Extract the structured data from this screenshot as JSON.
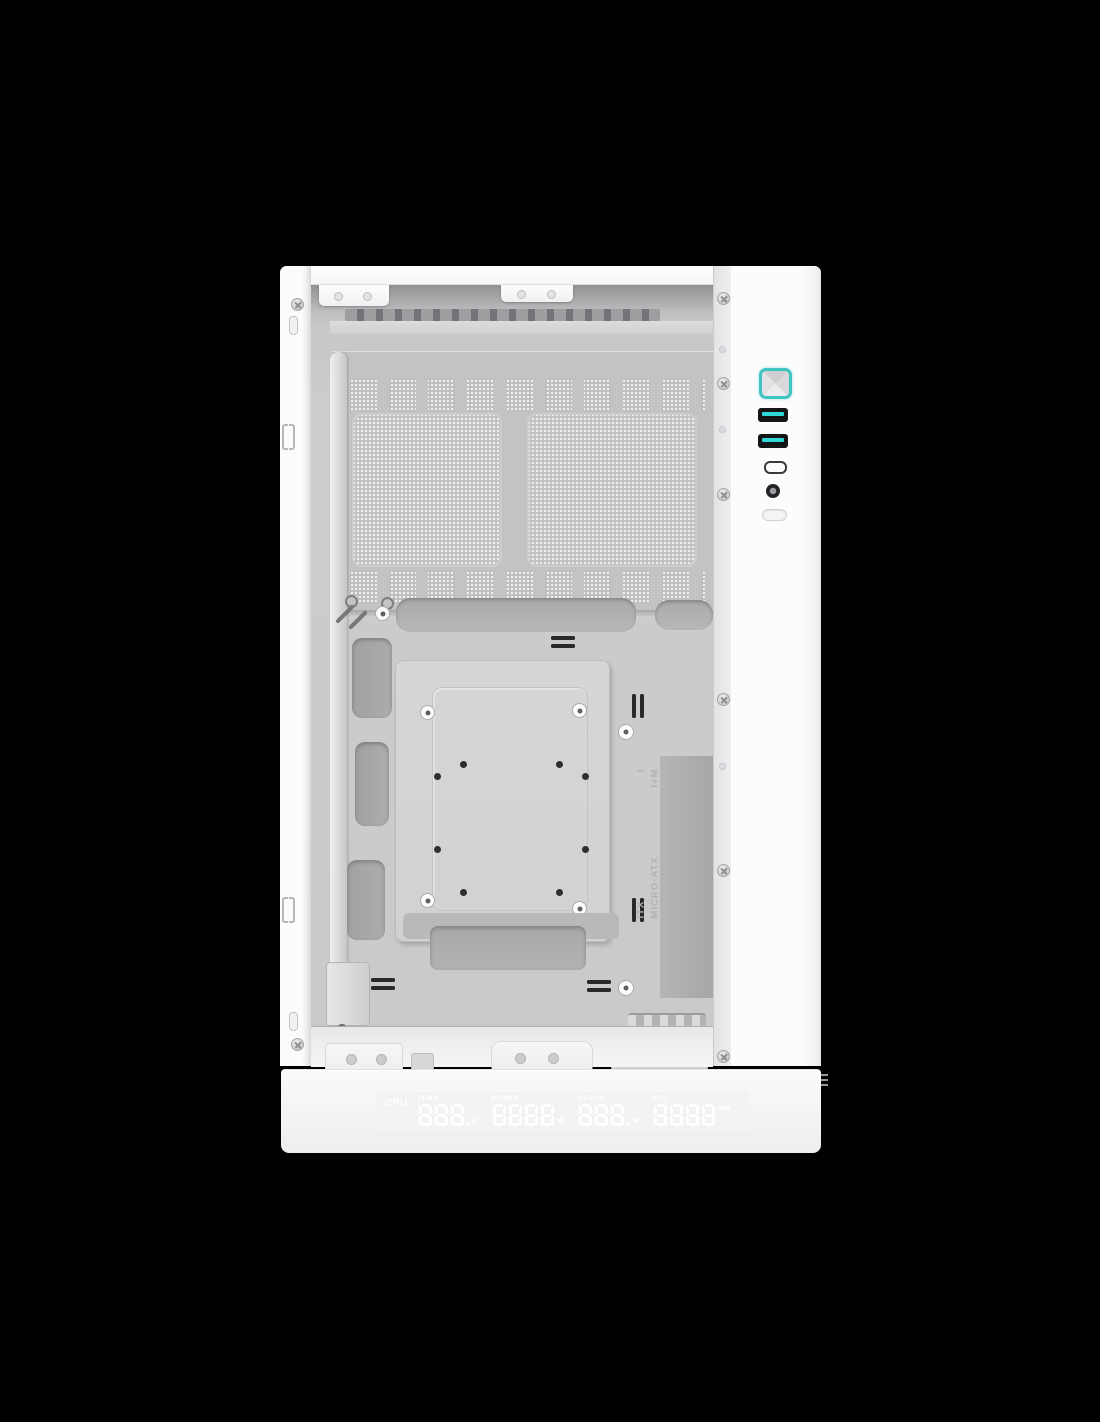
{
  "product": {
    "type": "pc-case-photo",
    "color_scheme": {
      "background": "#000000",
      "case_white": "#f7f7f8",
      "accent_teal": "#3fc4c0",
      "usb_cyan": "#2fd8d4",
      "logo_teal": "#28a69f"
    }
  },
  "io_panel": {
    "ports": [
      {
        "name": "power-button"
      },
      {
        "name": "usb-a-port-1"
      },
      {
        "name": "usb-a-port-2"
      },
      {
        "name": "usb-c-port"
      },
      {
        "name": "audio-jack"
      },
      {
        "name": "led-control-button"
      }
    ]
  },
  "tray": {
    "rows": [
      {
        "name": "ITX",
        "code": "I"
      },
      {
        "name": "MICRO-ATX",
        "code": "I+M"
      }
    ]
  },
  "display": {
    "cpu_label": "CPU",
    "groups": [
      {
        "label": "TEMP",
        "digits": "888.",
        "unit": "C",
        "unit_pos": "sub"
      },
      {
        "label": "POWER",
        "digits": "8888",
        "unit": "W",
        "unit_pos": "sub"
      },
      {
        "label": "USAGE",
        "digits": "888.",
        "unit": "%",
        "unit_pos": "sub"
      },
      {
        "label": "FRQ",
        "digits": "8888",
        "unit": "MHZ",
        "unit_pos": "sup"
      }
    ],
    "logo": "deepcool-logo"
  }
}
